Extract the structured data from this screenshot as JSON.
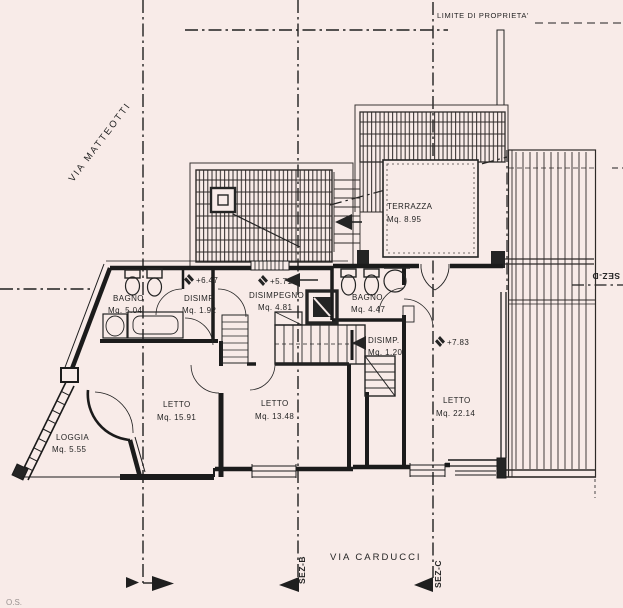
{
  "labels": {
    "property": "LIMITE DI PROPRIETA'",
    "via_matteotti": "VIA MATTEOTTI",
    "via_carducci": "VIA CARDUCCI",
    "sez_b": "SEZ-B",
    "sez_c": "SEZ-C",
    "sez_d": "SEZ-D",
    "corner_note": "O.S."
  },
  "levels": {
    "left": "+6.47",
    "center": "+5.71",
    "right": "+7.83"
  },
  "rooms": {
    "bagno_left": {
      "name": "BAGNO",
      "area": "Mq. 5.04"
    },
    "disimp_left": {
      "name": "DISIMP.",
      "area": "Mq. 1.92"
    },
    "disimpegno": {
      "name": "DISIMPEGNO",
      "area": "Mq. 4.81"
    },
    "bagno_right": {
      "name": "BAGNO",
      "area": "Mq. 4.47"
    },
    "disimp_right": {
      "name": "DISIMP.",
      "area": "Mq. 1.20"
    },
    "letto_left": {
      "name": "LETTO",
      "area": "Mq. 15.91"
    },
    "letto_center": {
      "name": "LETTO",
      "area": "Mq. 13.48"
    },
    "letto_right": {
      "name": "LETTO",
      "area": "Mq. 22.14"
    },
    "terrazza": {
      "name": "TERRAZZA",
      "area": "Mq. 8.95"
    },
    "loggia": {
      "name": "LOGGIA",
      "area": "Mq. 5.55"
    }
  },
  "colors": {
    "paper": "#f8ebe8",
    "ink": "#242424"
  }
}
